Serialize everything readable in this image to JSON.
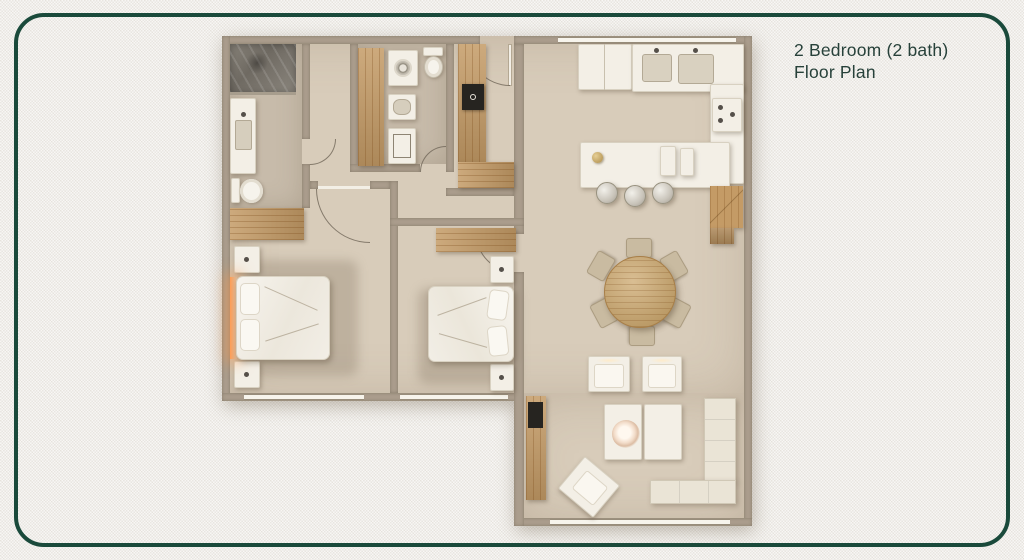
{
  "header": {
    "title_line1": "2 Bedroom (2 bath)",
    "title_line2": "Floor Plan"
  },
  "palette": {
    "background": "#f0eeea",
    "border_green": "#1a4a3b",
    "title_text": "#27413a",
    "wall": "#aa9d8c",
    "floor": "#d8ccba",
    "floor_bath": "#c7bbaa",
    "wood_light": "#c49b66",
    "wood_dark": "#9f7440",
    "table_wood": "#c9a264",
    "furniture_white": "#f3efe6",
    "sofa_cream": "#eae4d6",
    "glass_dark": "#7c766d",
    "appliance_black": "#262420",
    "lamp_glow": "#ff9d55"
  }
}
